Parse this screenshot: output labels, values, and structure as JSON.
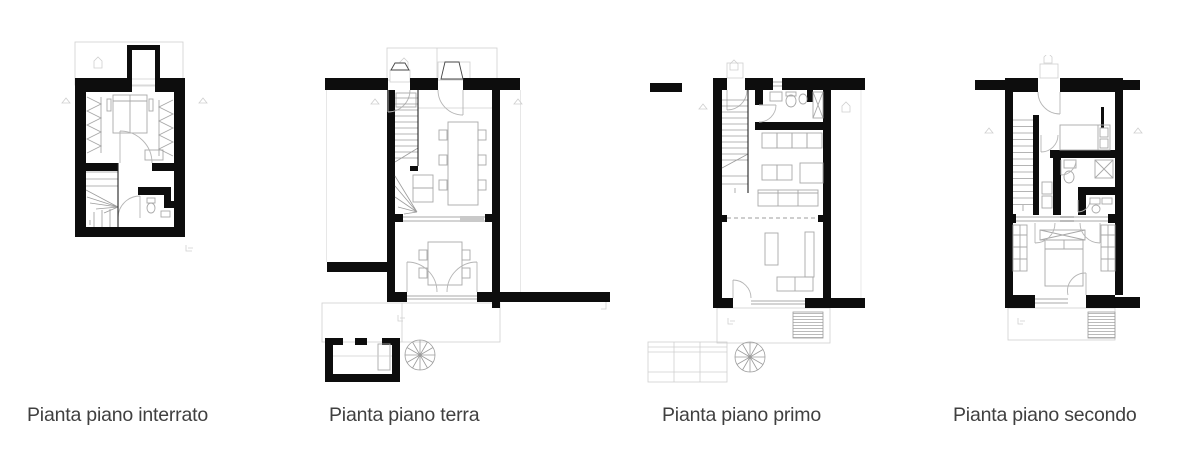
{
  "sheet": {
    "background": "#ffffff",
    "colors": {
      "wall": "#0d0d0d",
      "furniture_line": "#a8a8a8",
      "context_line": "#cfcfcf",
      "caption_text": "#404040"
    },
    "plans": [
      {
        "id": "interrato",
        "caption": "Pianta piano interrato"
      },
      {
        "id": "terra",
        "caption": "Pianta piano terra"
      },
      {
        "id": "primo",
        "caption": "Pianta piano primo"
      },
      {
        "id": "secondo",
        "caption": "Pianta piano secondo"
      }
    ]
  }
}
